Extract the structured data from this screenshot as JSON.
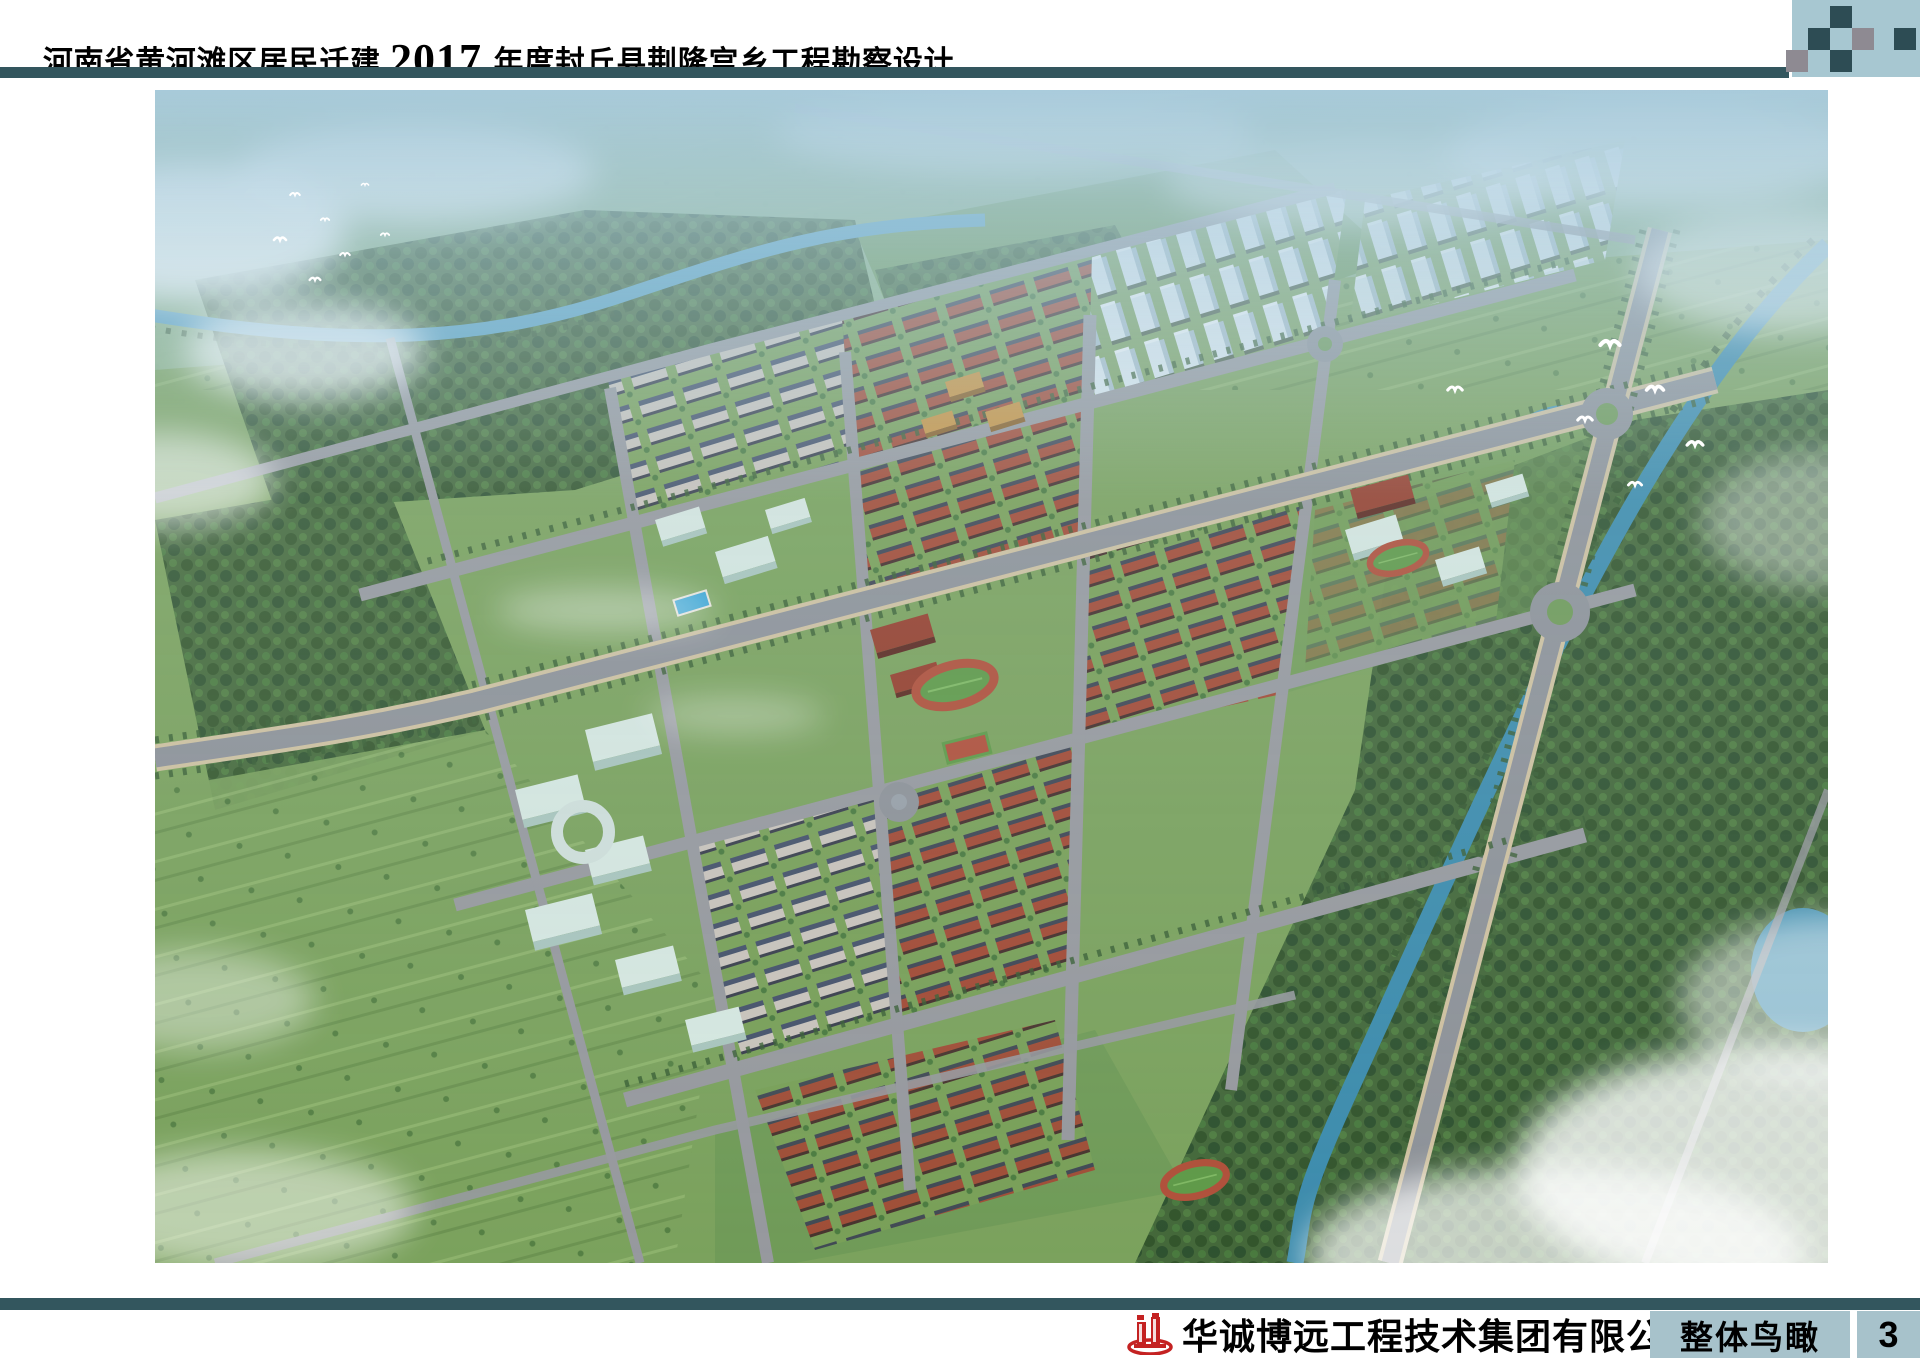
{
  "header": {
    "title_prefix": "河南省黄河滩区居民迁建",
    "title_year": "2017",
    "title_suffix": "年度封丘县荆隆宫乡工程勘察设计"
  },
  "main_image": {
    "alt": "规划区整体鸟瞰效果图"
  },
  "footer": {
    "company": "华诚博远工程技术集团有限公司",
    "section_label": "整体鸟瞰",
    "page_number": "3"
  },
  "palette": {
    "divider_teal": "#33565e",
    "corner_background": "#a7c7d1",
    "corner_square_dark": "#2d4c54",
    "corner_square_gray": "#8e8a92",
    "footer_label_background": "#a7c2cb",
    "logo_red": "#c42222",
    "text_color": "#000000"
  }
}
